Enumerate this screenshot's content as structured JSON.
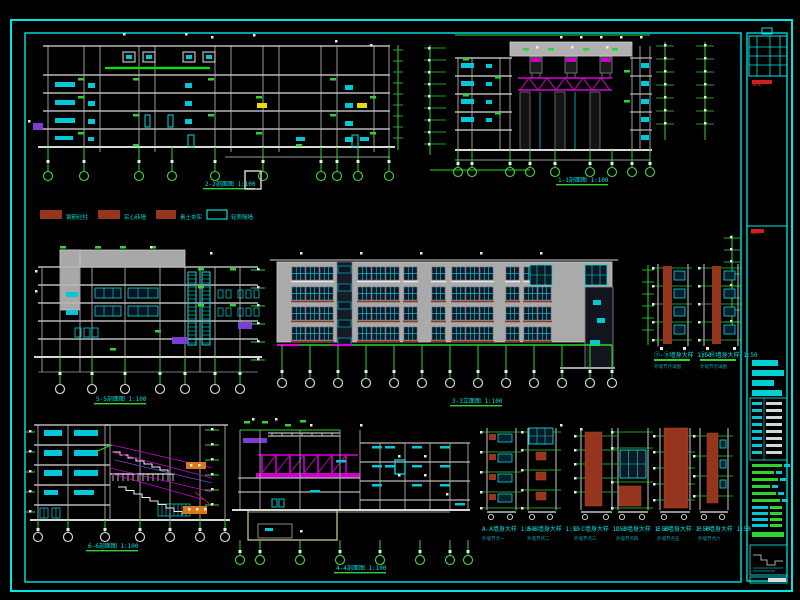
{
  "sheet": {
    "background": "#000000",
    "frame_color": "#00e6e6",
    "palette": {
      "structure_gray": "#9a9a9a",
      "facade_gray": "#b2b2b2",
      "line_white": "#eaeaea",
      "detail_cyan": "#00dcdc",
      "dim_green": "#2ed32e",
      "bright_green": "#00e400",
      "magenta": "#d800d8",
      "purple": "#7a3fd0",
      "yellow": "#e3e000",
      "brown": "#96351e",
      "orange": "#e07818",
      "khaki": "#d5d08a",
      "red": "#d42020",
      "window_dark": "#101826"
    }
  },
  "legend": {
    "items": [
      {
        "swatch_type": "filled",
        "swatch_color": "#96351e",
        "label": "钢筋砼柱"
      },
      {
        "swatch_type": "filled",
        "swatch_color": "#96351e",
        "label": "实心砖墙"
      },
      {
        "swatch_type": "filled",
        "swatch_color": "#96351e",
        "label": "素土夯实"
      },
      {
        "swatch_type": "outline",
        "swatch_color": "#00dcdc",
        "label": "轻质隔墙"
      }
    ]
  },
  "drawings": {
    "top_left_section": {
      "title": "2-2剖面图 1:100"
    },
    "top_right_section": {
      "title": "1-1剖面图 1:100"
    },
    "mid_left_section": {
      "title": "5-5剖面图 1:100"
    },
    "main_elevation": {
      "title": "3-3立面图 1:100"
    },
    "auditorium_section": {
      "title": "6-6剖面图 1:100"
    },
    "bottom_mid_section": {
      "title": "4-4剖面图 1:100"
    },
    "wall_details_upper": [
      {
        "title": "①-⑤墙身大样 1:50",
        "subtitle": "外墙节点详图"
      },
      {
        "title": "⑤-⑨墙身大样 1:50",
        "subtitle": "外墙节点详图"
      }
    ],
    "wall_details_lower": [
      {
        "title": "A-A墙身大样 1:50",
        "subtitle": "外墙节点一"
      },
      {
        "title": "B-B墙身大样 1:50",
        "subtitle": "外墙节点二"
      },
      {
        "title": "C-C墙身大样 1:50",
        "subtitle": "外墙节点三"
      },
      {
        "title": "D-D墙身大样 1:50",
        "subtitle": "外墙节点四"
      },
      {
        "title": "E-E墙身大样 1:50",
        "subtitle": "外墙节点五"
      },
      {
        "title": "F-F墙身大样 1:50",
        "subtitle": "外墙节点六"
      }
    ]
  },
  "title_block": {
    "signoff_note": "审定",
    "revision_note": "版次",
    "notes_heading": "说明",
    "detail_caption": "节点详图",
    "sheet_number": "建施-05"
  }
}
